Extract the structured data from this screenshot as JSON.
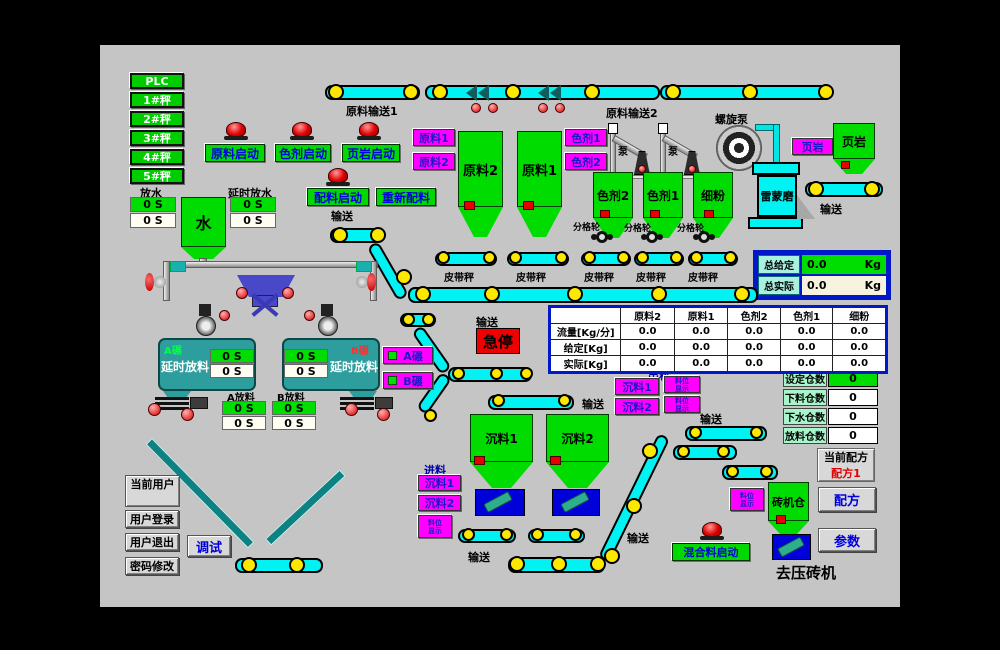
{
  "plc_panel": {
    "items": [
      "PLC",
      "1#秤",
      "2#秤",
      "3#秤",
      "4#秤",
      "5#秤"
    ]
  },
  "water": {
    "fangshui": "放水",
    "yanshi_fangshui": "延时放水",
    "tank": "水",
    "timer_set": "0 S",
    "timer_act": "0 S"
  },
  "start_buttons": {
    "yuanliao": "原料启动",
    "seji": "色剂启动",
    "yeyan": "页岩启动",
    "peiliao": "配料启动",
    "chongxin_peiliao": "重新配料",
    "hunheliao": "混合料启动",
    "jiting": "急停"
  },
  "conveyors": {
    "top1": "原料输送1",
    "top2": "原料输送2",
    "shusong": "输送",
    "pidaicheng": "皮带秤"
  },
  "equipment": {
    "beng": "泵",
    "luoxuan_beng": "螺旋泵",
    "leimeng_mo": "雷蒙磨",
    "fengelun": "分格轮",
    "chuliao": "出料",
    "jinliao": "进料",
    "quyazhuanji": "去压砖机"
  },
  "hoppers": {
    "yuanliao2": "原料2",
    "yuanliao1": "原料1",
    "seji2": "色剂2",
    "seji1": "色剂1",
    "xifen": "细粉",
    "yeyan": "页岩",
    "chenliao1": "沉料1",
    "chenliao2": "沉料2",
    "zhuanjicang": "砖机仓"
  },
  "gate_buttons": {
    "yuanliao1": "原料1",
    "yuanliao2": "原料2",
    "seji1": "色剂1",
    "seji2": "色剂2",
    "yeyan": "页岩",
    "chenliao1": "沉料1",
    "chenliao2": "沉料2",
    "a_nian": "A碾",
    "b_nian": "B碾",
    "tiny_top": "料位",
    "tiny_bottom": "显示"
  },
  "tanks": {
    "a_label": "A碾",
    "b_label": "B碾",
    "yanshi_fangliao": "延时放料",
    "a_fangliao": "A放料",
    "b_fangliao": "B放料",
    "timer": "0 S"
  },
  "totals": {
    "given_label": "总给定",
    "actual_label": "总实际",
    "given_value": "0.0",
    "actual_value": "0.0",
    "unit": "Kg"
  },
  "table": {
    "headers": [
      "",
      "原料2",
      "原料1",
      "色剂2",
      "色剂1",
      "细粉"
    ],
    "rows": [
      {
        "label": "流量[Kg/分]",
        "values": [
          "0.0",
          "0.0",
          "0.0",
          "0.0",
          "0.0"
        ]
      },
      {
        "label": "给定[Kg]",
        "values": [
          "0.0",
          "0.0",
          "0.0",
          "0.0",
          "0.0"
        ]
      },
      {
        "label": "实际[Kg]",
        "values": [
          "0.0",
          "0.0",
          "0.0",
          "0.0",
          "0.0"
        ]
      }
    ]
  },
  "bin_counts": {
    "rows": [
      {
        "label": "设定仓数",
        "value": "0"
      },
      {
        "label": "下料仓数",
        "value": "0"
      },
      {
        "label": "下水仓数",
        "value": "0"
      },
      {
        "label": "放料仓数",
        "value": "0"
      }
    ]
  },
  "recipe": {
    "current_label": "当前配方",
    "current_value": "配方1",
    "peifang": "配方",
    "canshu": "参数"
  },
  "user_panel": {
    "current_user": "当前用户",
    "login": "用户登录",
    "logout": "用户退出",
    "password": "密码修改",
    "debug": "调试"
  },
  "colors": {
    "panel_bg": "#c5c5c5",
    "button_green": "#00d800",
    "button_magenta": "#ff00ff",
    "belt_cyan": "#00f2f2",
    "roller_yellow": "#ffe800",
    "tank_teal": "#2d9d9d",
    "alarm_red": "#e00000",
    "text_blue": "#0000e0",
    "table_border_blue": "#0018c8"
  }
}
